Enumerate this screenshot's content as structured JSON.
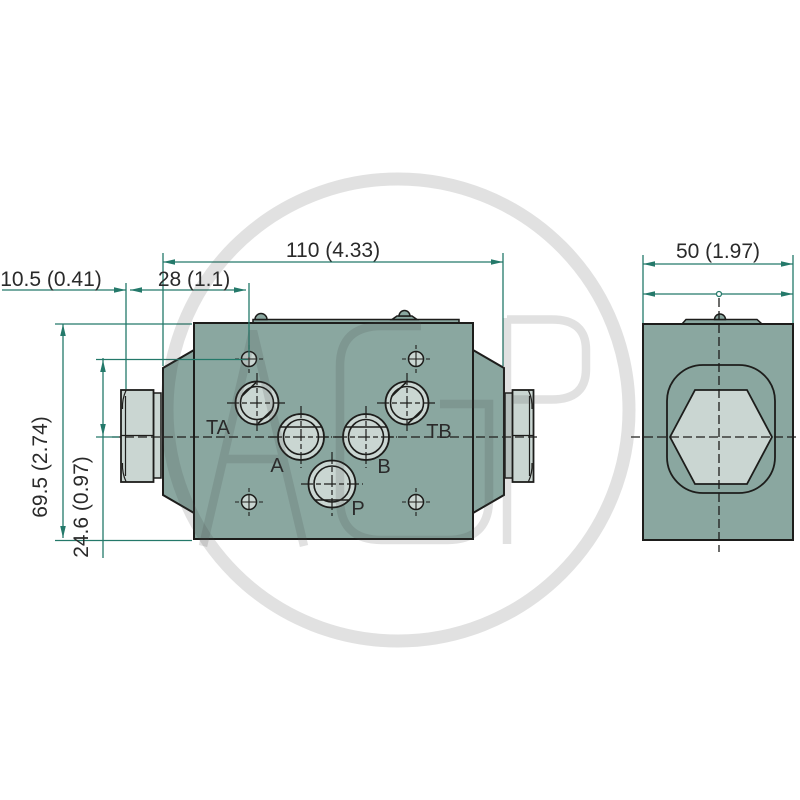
{
  "drawing": {
    "type": "technical-dimension-drawing",
    "views": [
      "front-view-valve-block",
      "side-view-valve-block"
    ]
  },
  "dimensions": {
    "top_width": "110 (4.33)",
    "hole_offset": "28 (1.1)",
    "plug_protrusion": "10.5 (0.41)",
    "block_height": "69.5 (2.74)",
    "center_height": "24.6 (0.97)",
    "side_width": "50 (1.97)"
  },
  "ports": {
    "ta": "TA",
    "a": "A",
    "b": "B",
    "tb": "TB",
    "p": "P"
  },
  "watermark": {
    "letters": "AGP"
  },
  "colors": {
    "body": "#8aa7a0",
    "machined_faces": "#cad6d2",
    "outline": "#1d1d1b",
    "dimension_lines": "#24796a",
    "dimension_text": "#2a2a2a",
    "watermark": "#e1e1e1"
  }
}
